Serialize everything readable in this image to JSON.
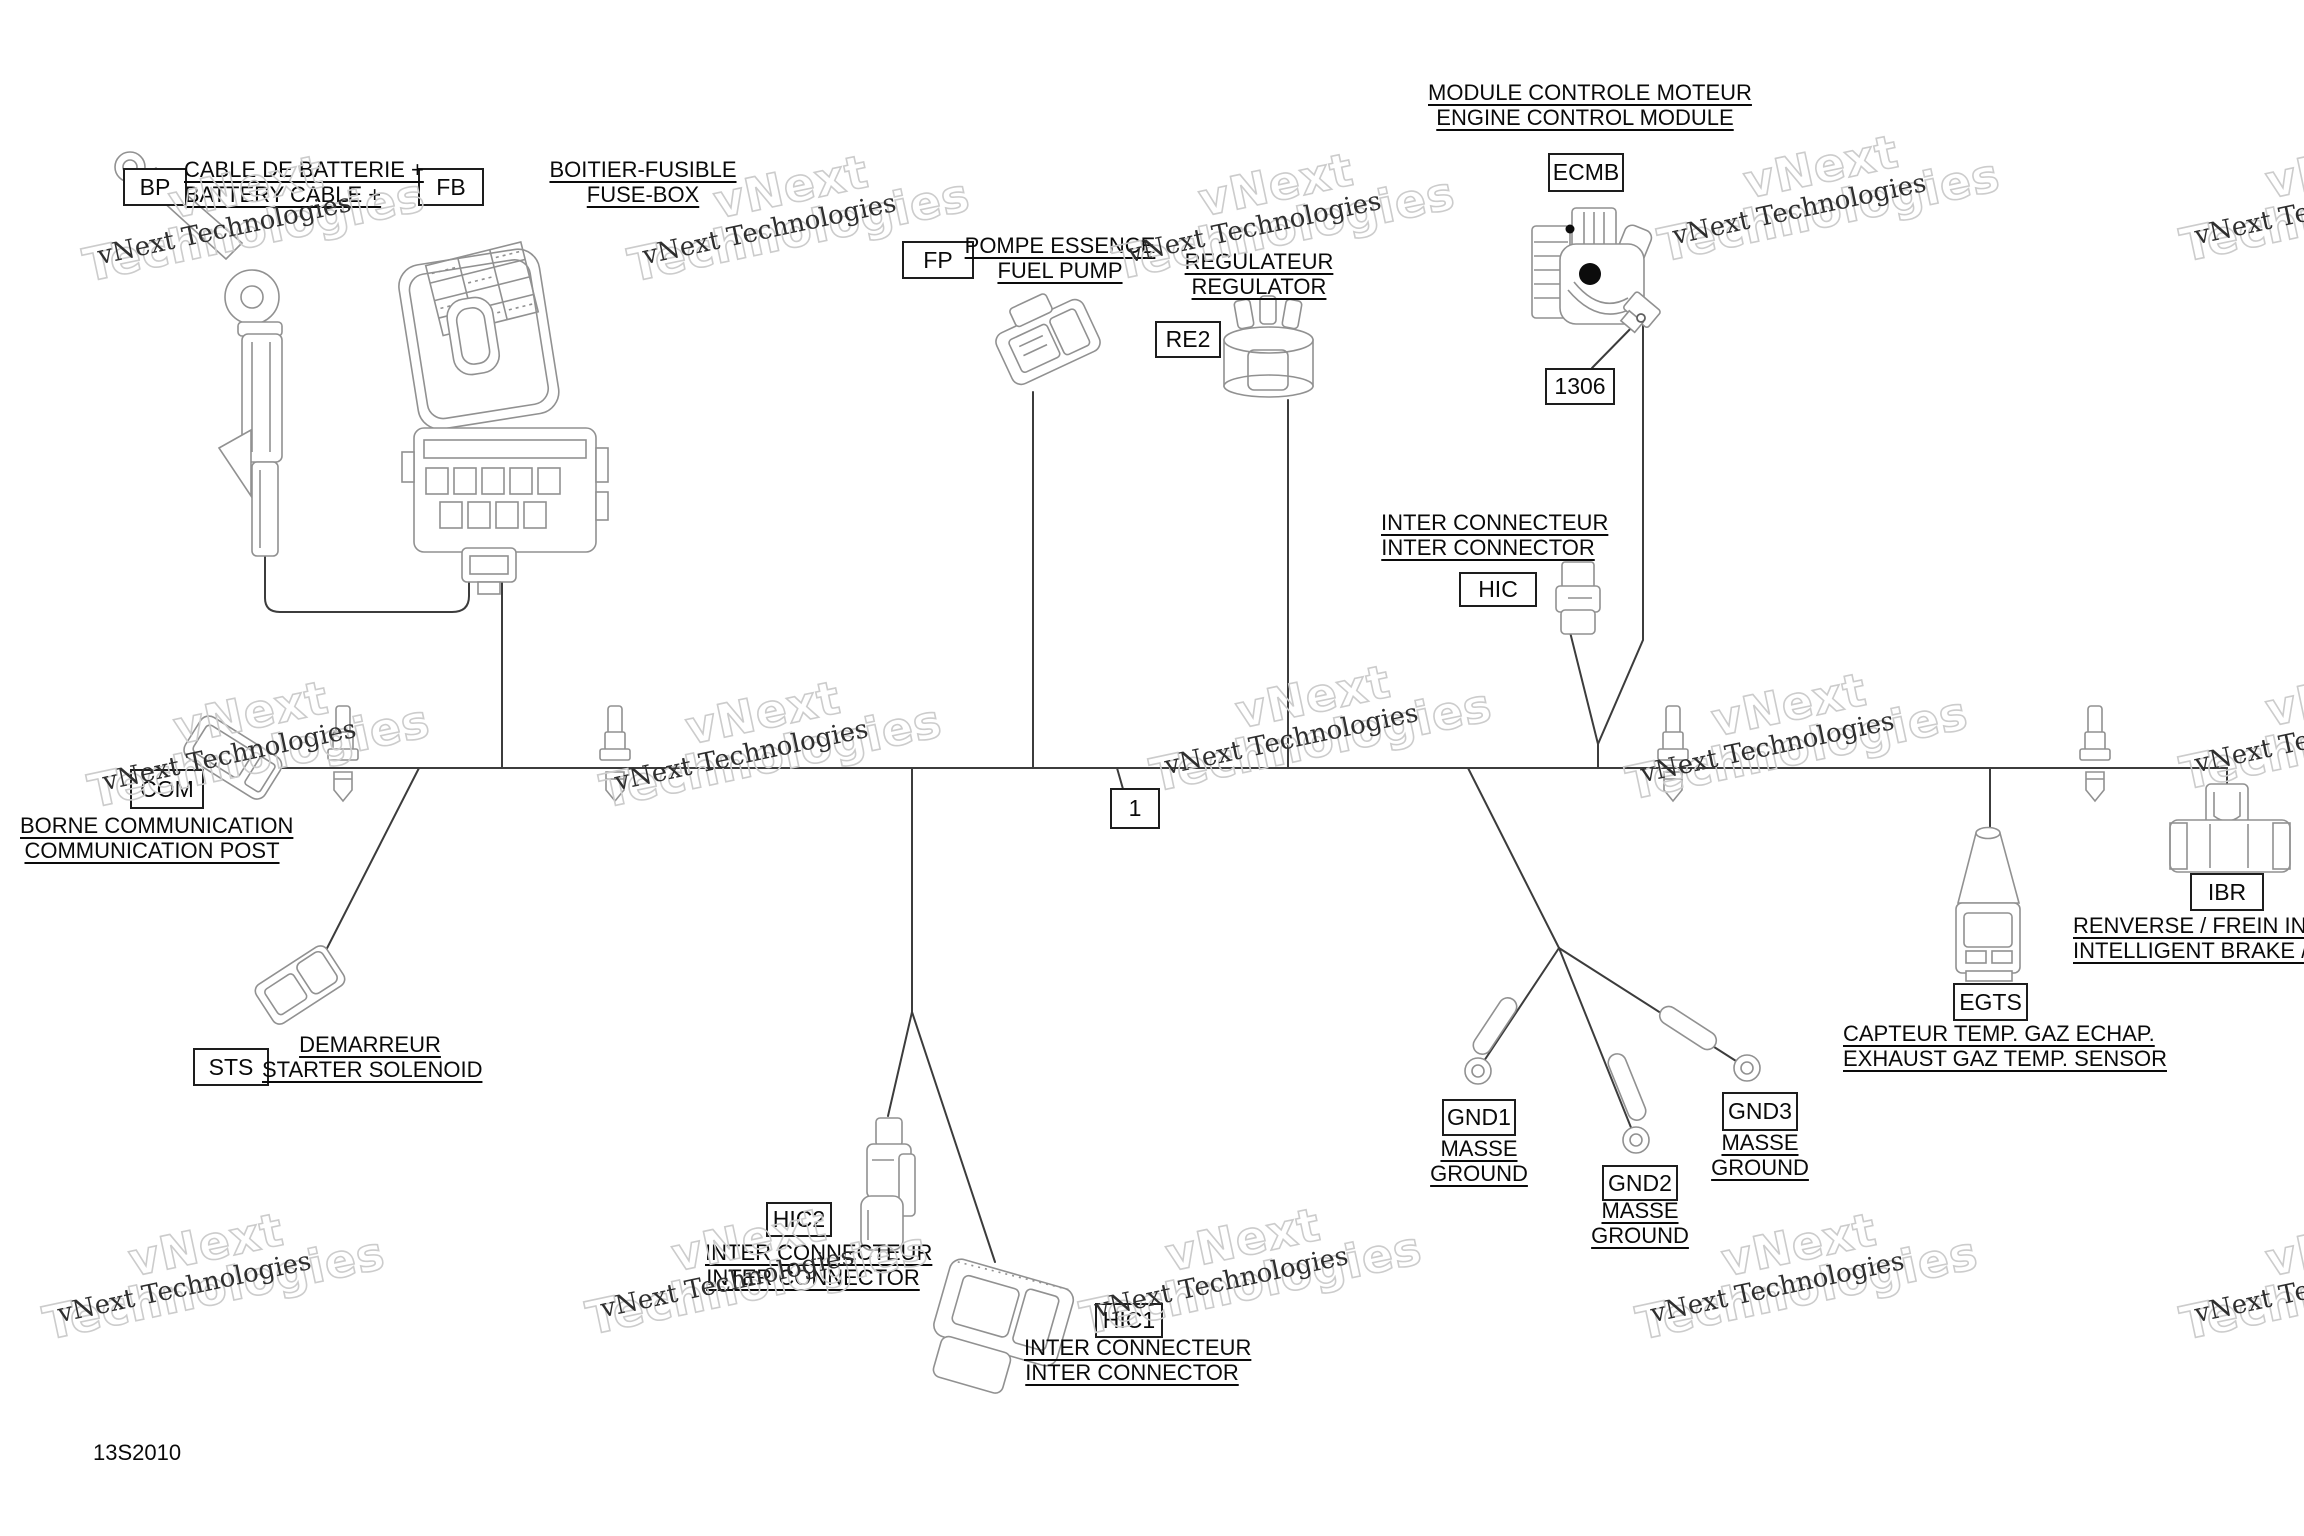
{
  "page": {
    "code": "13S2010"
  },
  "watermark": {
    "small": "vNext Technologies",
    "big1": "vNext",
    "big2": "Technologies",
    "positions": [
      {
        "x": 225,
        "y": 232
      },
      {
        "x": 770,
        "y": 232
      },
      {
        "x": 1255,
        "y": 230
      },
      {
        "x": 1800,
        "y": 212
      },
      {
        "x": 2322,
        "y": 212
      },
      {
        "x": 230,
        "y": 758
      },
      {
        "x": 742,
        "y": 758
      },
      {
        "x": 1292,
        "y": 742
      },
      {
        "x": 1768,
        "y": 750
      },
      {
        "x": 2322,
        "y": 740
      },
      {
        "x": 185,
        "y": 1290
      },
      {
        "x": 728,
        "y": 1285
      },
      {
        "x": 1222,
        "y": 1285
      },
      {
        "x": 1778,
        "y": 1290
      },
      {
        "x": 2322,
        "y": 1290
      }
    ]
  },
  "components": {
    "bp": {
      "code": "BP",
      "label_line1": "CABLE DE BATTERIE +",
      "label_line2": "BATTERY CABLE +"
    },
    "fb": {
      "code": "FB",
      "label_line1": "BOITIER-FUSIBLE",
      "label_line2": "FUSE-BOX"
    },
    "fp": {
      "code": "FP",
      "label_line1": "POMPE ESSENCE",
      "label_line2": "FUEL PUMP"
    },
    "re2": {
      "code": "RE2",
      "label_line1": "REGULATEUR",
      "label_line2": "REGULATOR"
    },
    "ecmb": {
      "code": "ECMB",
      "label_line1": "MODULE CONTROLE MOTEUR",
      "label_line2": "ENGINE CONTROL MODULE"
    },
    "ref1306": {
      "code": "1306"
    },
    "callout1": {
      "code": "1"
    },
    "hic": {
      "code": "HIC",
      "label_line1": "INTER CONNECTEUR",
      "label_line2": "INTER CONNECTOR"
    },
    "com": {
      "code": "COM",
      "label_line1": "BORNE COMMUNICATION",
      "label_line2": "COMMUNICATION POST"
    },
    "sts": {
      "code": "STS",
      "label_line1": "DEMARREUR",
      "label_line2": "STARTER SOLENOID"
    },
    "hic2": {
      "code": "HIC2",
      "label_line1": "INTER CONNECTEUR",
      "label_line2": "INTER CONNECTOR"
    },
    "hic1": {
      "code": "HIC1",
      "label_line1": "INTER CONNECTEUR",
      "label_line2": "INTER CONNECTOR"
    },
    "gnd1": {
      "code": "GND1",
      "label_line1": "MASSE",
      "label_line2": "GROUND"
    },
    "gnd2": {
      "code": "GND2",
      "label_line1": "MASSE",
      "label_line2": "GROUND"
    },
    "gnd3": {
      "code": "GND3",
      "label_line1": "MASSE",
      "label_line2": "GROUND"
    },
    "egts": {
      "code": "EGTS",
      "label_line1": "CAPTEUR TEMP. GAZ ECHAP.",
      "label_line2": "EXHAUST GAZ TEMP. SENSOR"
    },
    "ibr": {
      "code": "IBR",
      "label_line1": "RENVERSE / FREIN INTE",
      "label_line2": "INTELLIGENT BRAKE / R"
    }
  }
}
